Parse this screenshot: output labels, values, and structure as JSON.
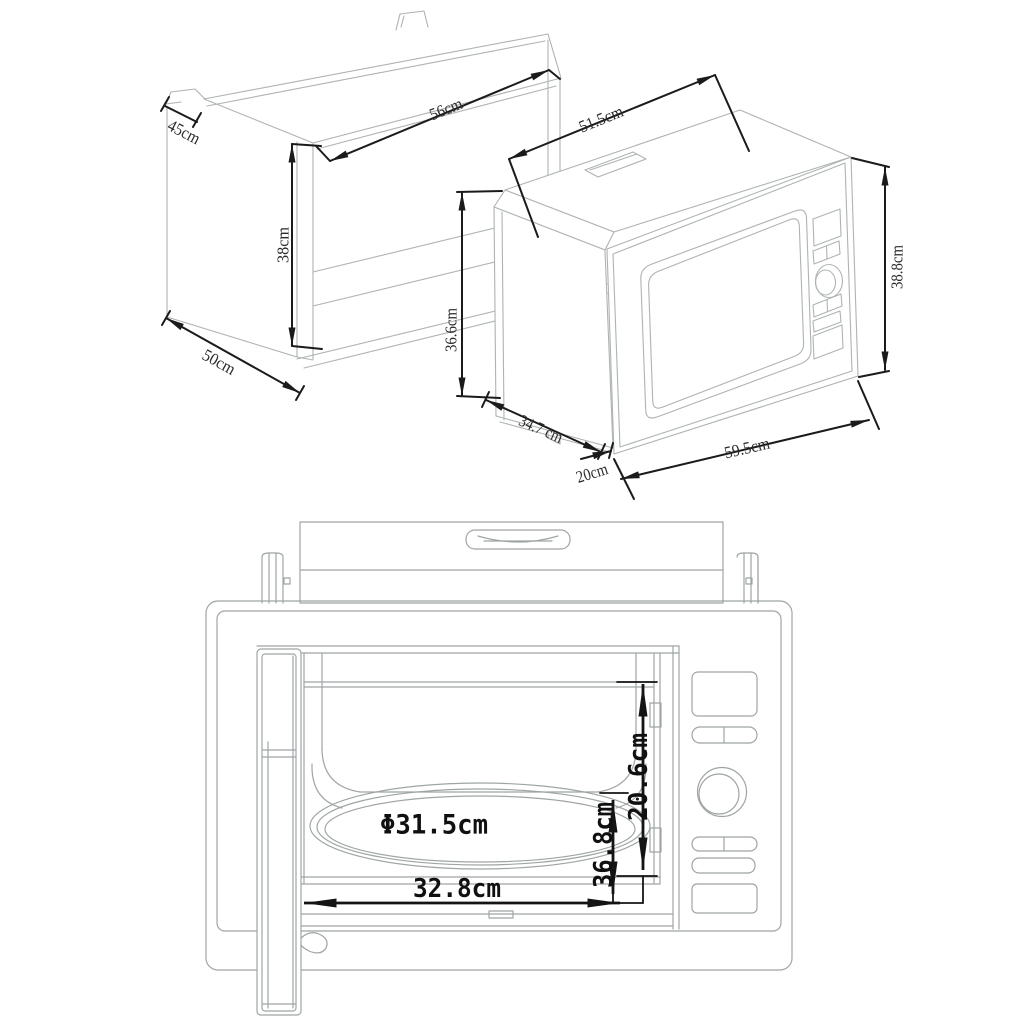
{
  "colors": {
    "background": "#ffffff",
    "outline_light": "#aeb3b3",
    "outline_front": "#9fa5a5",
    "dimension": "#1b1b1b"
  },
  "cabinet_view": {
    "labels": {
      "top_depth": "45cm",
      "niche_width": "56cm",
      "niche_height": "38cm",
      "bottom_depth": "50cm"
    }
  },
  "microwave_view": {
    "labels": {
      "body_width": "51.5cm",
      "body_height": "36.6cm",
      "body_depth": "34.7 cm",
      "trim_depth": "20cm",
      "trim_width": "59.5cm",
      "trim_height": "38.8cm"
    }
  },
  "front_view": {
    "labels": {
      "turntable_diameter": "Φ31.5cm",
      "cavity_height": "20.6cm",
      "door_width": "36.8cm",
      "cavity_width": "32.8cm"
    }
  }
}
